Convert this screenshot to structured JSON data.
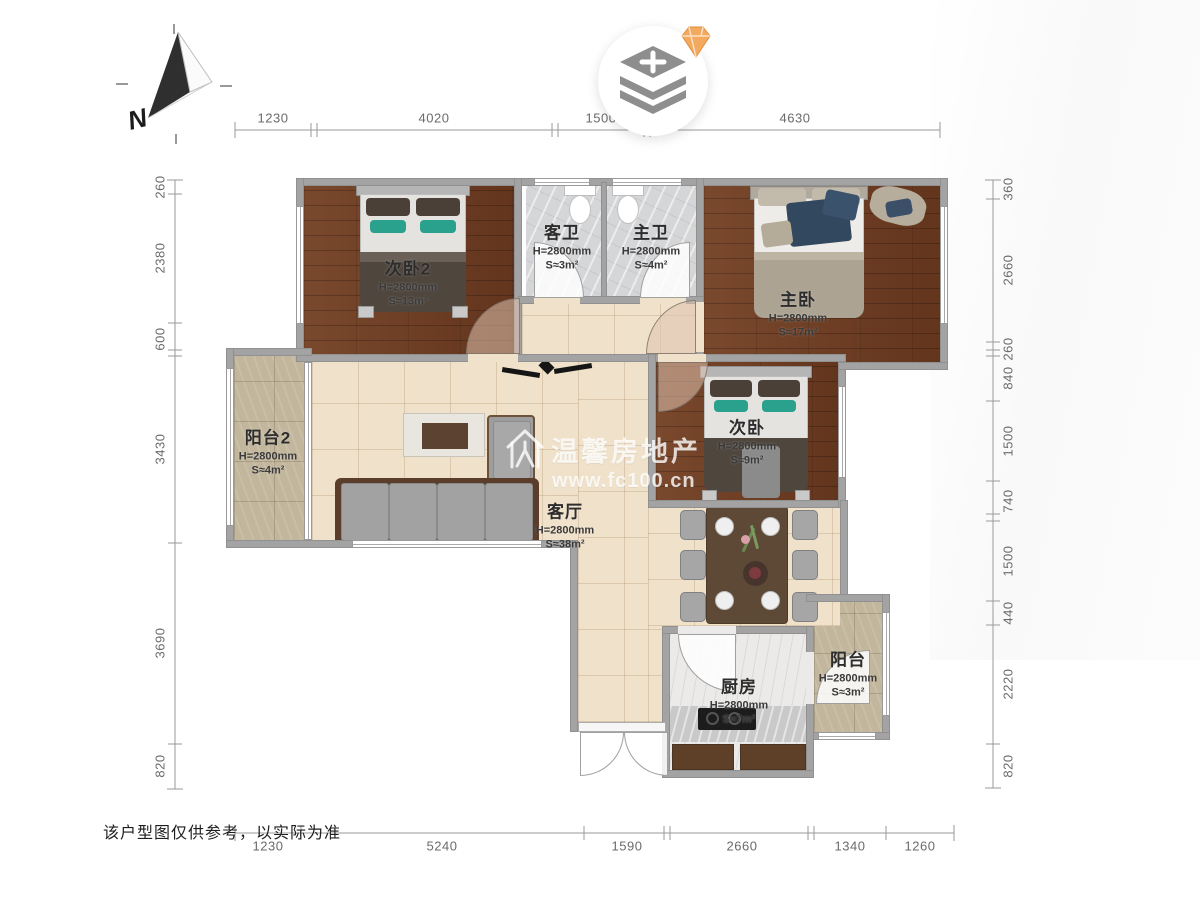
{
  "page": {
    "disclaimer": "该户型图仅供参考，以实际为准",
    "compass_label": "N"
  },
  "watermark": {
    "brand": "温馨房地产",
    "url": "www.fc100.cn"
  },
  "rooms": [
    {
      "id": "bedroom2",
      "name": "次卧2",
      "height": "H=2800mm",
      "area": "S≈13m²"
    },
    {
      "id": "guest_bath",
      "name": "客卫",
      "height": "H=2800mm",
      "area": "S≈3m²"
    },
    {
      "id": "master_bath",
      "name": "主卫",
      "height": "H=2800mm",
      "area": "S≈4m²"
    },
    {
      "id": "master_bedroom",
      "name": "主卧",
      "height": "H=2800mm",
      "area": "S≈17m²"
    },
    {
      "id": "bedroom",
      "name": "次卧",
      "height": "H=2800mm",
      "area": "S≈9m²"
    },
    {
      "id": "balcony2",
      "name": "阳台2",
      "height": "H=2800mm",
      "area": "S≈4m²"
    },
    {
      "id": "living",
      "name": "客厅",
      "height": "H=2800mm",
      "area": "S≈38m²"
    },
    {
      "id": "kitchen",
      "name": "厨房",
      "height": "H=2800mm",
      "area": "S≈7m²"
    },
    {
      "id": "balcony",
      "name": "阳台",
      "height": "H=2800mm",
      "area": "S≈3m²"
    }
  ],
  "dimensions": {
    "top": [
      "1230",
      "4020",
      "1500",
      "4630"
    ],
    "bottom": [
      "1230",
      "5240",
      "1590",
      "2660",
      "1340",
      "1260"
    ],
    "left": [
      "260",
      "2380",
      "600",
      "3430",
      "3690",
      "820"
    ],
    "right": [
      "360",
      "2660",
      "260",
      "840",
      "1500",
      "740",
      "1500",
      "440",
      "2220",
      "820"
    ]
  }
}
